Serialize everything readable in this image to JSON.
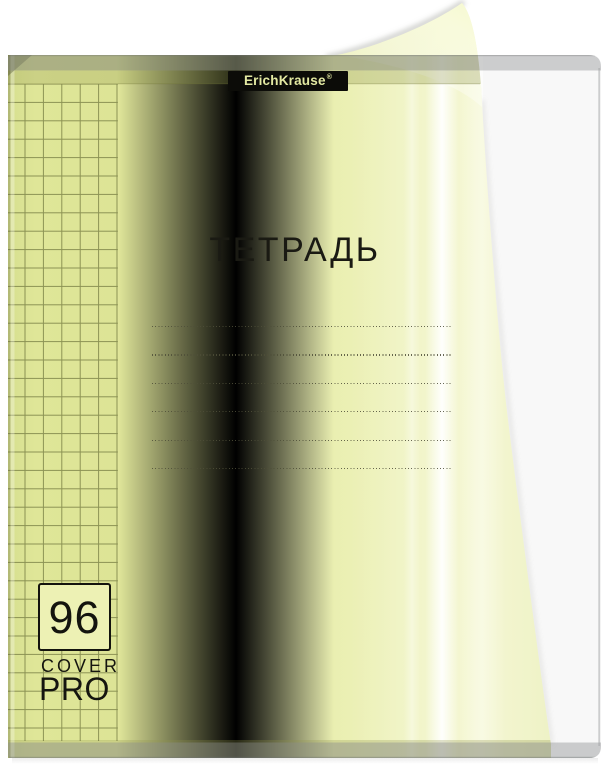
{
  "product": {
    "brand": "ErichKrause",
    "registered_mark": "®",
    "title": "ТЕТРАДЬ",
    "sheet_count": "96",
    "cover_series_line1": "COVER",
    "cover_series_line2": "PRO",
    "name_lines_count": 6
  },
  "colors": {
    "page_background": "#ffffff",
    "cover_yellow": "#e7ecа6",
    "cover_yellow_deep": "#dce494",
    "cover_yellow_pale": "#f5f7d3",
    "top_edge_olive": "#bcc37c",
    "plastic_edge_gray": "#c6c8ca",
    "grid_line": "#3a4012",
    "logo_background": "#0c0c08",
    "logo_text": "#e3e9a2",
    "print_black": "#15150f"
  }
}
